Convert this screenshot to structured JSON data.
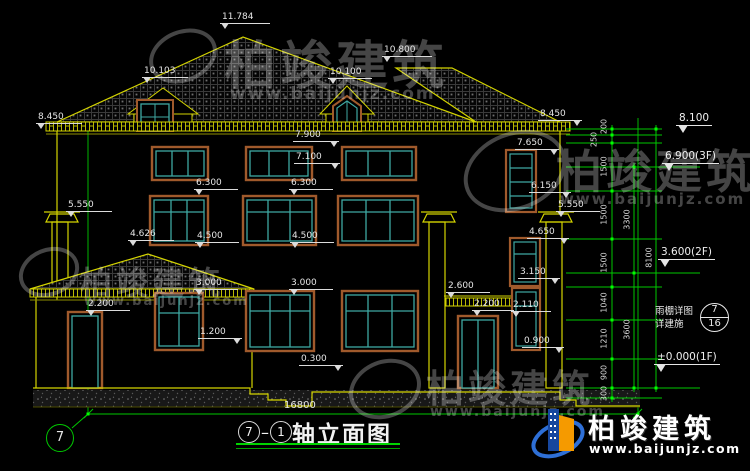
{
  "drawing": {
    "title": {
      "axis_a": "7",
      "axis_b": "1",
      "name": "轴立面图"
    },
    "overall_width_mm": "16800",
    "axis_bubble_left": "7",
    "callout": {
      "line1": "雨棚详图",
      "line2": "详建施",
      "detail_no": "7",
      "sheet_no": "16"
    },
    "floor_levels": [
      {
        "t": "8.100",
        "x": 676,
        "y": 112
      },
      {
        "t": "6.900(3F)",
        "x": 662,
        "y": 150
      },
      {
        "t": "3.600(2F)",
        "x": 658,
        "y": 246
      },
      {
        "t": "±0.000(1F)",
        "x": 654,
        "y": 351
      }
    ],
    "spot_levels": [
      {
        "t": "11.784",
        "x": 220,
        "y": 12,
        "w": 46
      },
      {
        "t": "10.800",
        "x": 382,
        "y": 45,
        "w": 46
      },
      {
        "t": "10.103",
        "x": 142,
        "y": 66,
        "w": 42
      },
      {
        "t": "10.100",
        "x": 328,
        "y": 67,
        "w": 40
      },
      {
        "t": "8.450",
        "x": 36,
        "y": 112,
        "w": 42
      },
      {
        "t": "8.450",
        "x": 538,
        "y": 109,
        "w": 40,
        "tri": "r"
      },
      {
        "t": "7.900",
        "x": 293,
        "y": 130,
        "w": 42,
        "tri": "r"
      },
      {
        "t": "7.650",
        "x": 515,
        "y": 138,
        "w": 40,
        "tri": "r"
      },
      {
        "t": "7.100",
        "x": 294,
        "y": 152,
        "w": 42,
        "tri": "r"
      },
      {
        "t": "6.300",
        "x": 194,
        "y": 178,
        "w": 40
      },
      {
        "t": "6.300",
        "x": 289,
        "y": 178,
        "w": 40
      },
      {
        "t": "6.150",
        "x": 529,
        "y": 181,
        "w": 38,
        "tri": "r"
      },
      {
        "t": "5.550",
        "x": 66,
        "y": 200,
        "w": 42
      },
      {
        "t": "5.550",
        "x": 556,
        "y": 200,
        "w": 40
      },
      {
        "t": "4.626",
        "x": 128,
        "y": 229,
        "w": 42
      },
      {
        "t": "4.500",
        "x": 195,
        "y": 231,
        "w": 40
      },
      {
        "t": "4.500",
        "x": 290,
        "y": 231,
        "w": 40
      },
      {
        "t": "4.650",
        "x": 527,
        "y": 227,
        "w": 38,
        "tri": "r"
      },
      {
        "t": "3.000",
        "x": 194,
        "y": 278,
        "w": 40
      },
      {
        "t": "3.000",
        "x": 289,
        "y": 278,
        "w": 40
      },
      {
        "t": "3.150",
        "x": 518,
        "y": 267,
        "w": 38,
        "tri": "r"
      },
      {
        "t": "2.600",
        "x": 446,
        "y": 281,
        "w": 40
      },
      {
        "t": "2.200",
        "x": 86,
        "y": 299,
        "w": 40
      },
      {
        "t": "2.200",
        "x": 472,
        "y": 299,
        "w": 38
      },
      {
        "t": "2.110",
        "x": 511,
        "y": 300,
        "w": 36
      },
      {
        "t": "1.200",
        "x": 198,
        "y": 327,
        "w": 40,
        "tri": "r"
      },
      {
        "t": "0.300",
        "x": 299,
        "y": 354,
        "w": 40,
        "tri": "r"
      },
      {
        "t": "0.900",
        "x": 522,
        "y": 336,
        "w": 38,
        "tri": "r"
      }
    ],
    "chain_dims": [
      {
        "t": "200",
        "cx": 604,
        "cy": 127
      },
      {
        "t": "250",
        "cx": 594,
        "cy": 140
      },
      {
        "t": "1500",
        "cx": 604,
        "cy": 167
      },
      {
        "t": "1500",
        "cx": 604,
        "cy": 215
      },
      {
        "t": "1500",
        "cx": 604,
        "cy": 263
      },
      {
        "t": "1040",
        "cx": 604,
        "cy": 303
      },
      {
        "t": "1210",
        "cx": 604,
        "cy": 339
      },
      {
        "t": "900",
        "cx": 604,
        "cy": 373
      },
      {
        "t": "300",
        "cx": 604,
        "cy": 394
      },
      {
        "t": "3300",
        "cx": 627,
        "cy": 220
      },
      {
        "t": "3600",
        "cx": 627,
        "cy": 330
      },
      {
        "t": "8100",
        "cx": 649,
        "cy": 258
      }
    ]
  },
  "watermark": {
    "name": "柏竣建筑",
    "url": "www.baijunjz.com"
  },
  "brand": {
    "name": "柏竣建筑",
    "url": "www.baijunjz.com"
  },
  "colors": {
    "line_yellow": "#d4d400",
    "dim_green": "#00c800",
    "tick_green": "#00ff00",
    "frame_brown": "#a05a2c",
    "frame_teal": "#3fa8a2",
    "text_white": "#e6e6e6"
  }
}
